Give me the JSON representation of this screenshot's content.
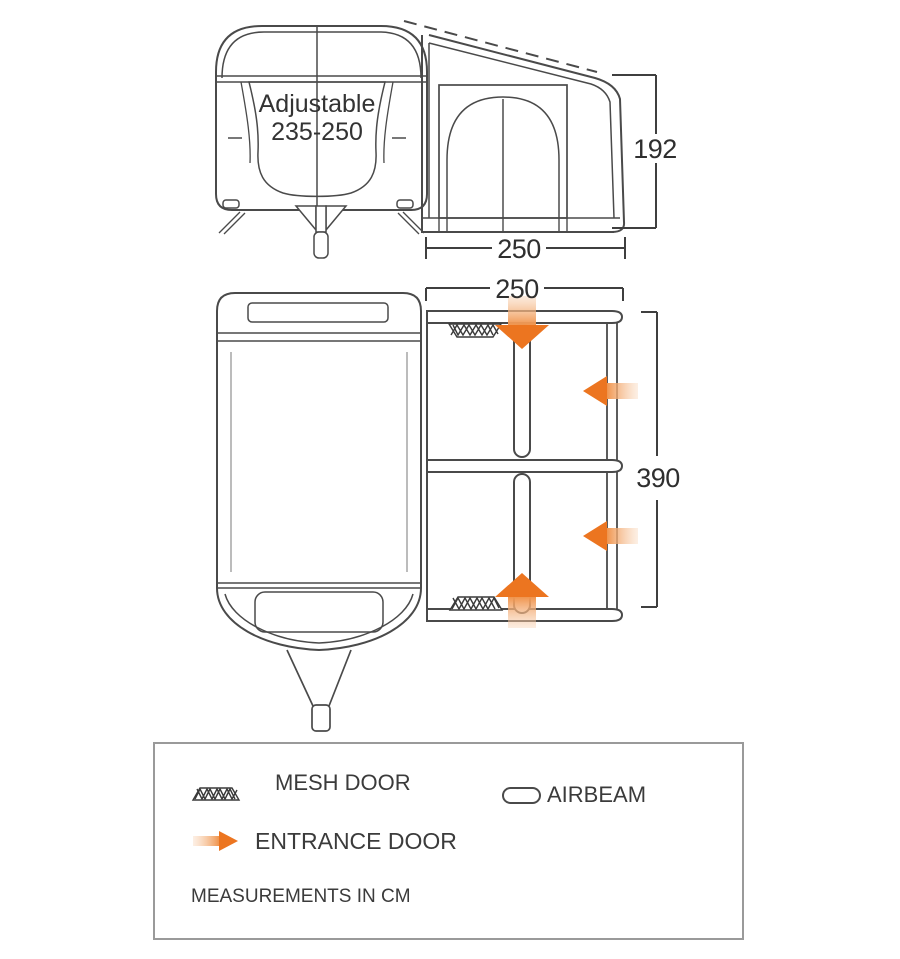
{
  "front_view": {
    "adjustable_label": "Adjustable",
    "adjustable_range": "235-250"
  },
  "side_view": {
    "height_cm": "192",
    "depth_cm": "250"
  },
  "plan_view": {
    "width_cm": "250",
    "length_cm": "390"
  },
  "legend": {
    "mesh_door_label": "MESH DOOR",
    "airbeam_label": "AIRBEAM",
    "entrance_door_label": "ENTRANCE DOOR",
    "measurements_note": "MEASUREMENTS IN CM"
  },
  "colors": {
    "accent_orange": "#EC7520",
    "line_gray": "#4A4A4A",
    "text_dark": "#3B3B3B"
  }
}
